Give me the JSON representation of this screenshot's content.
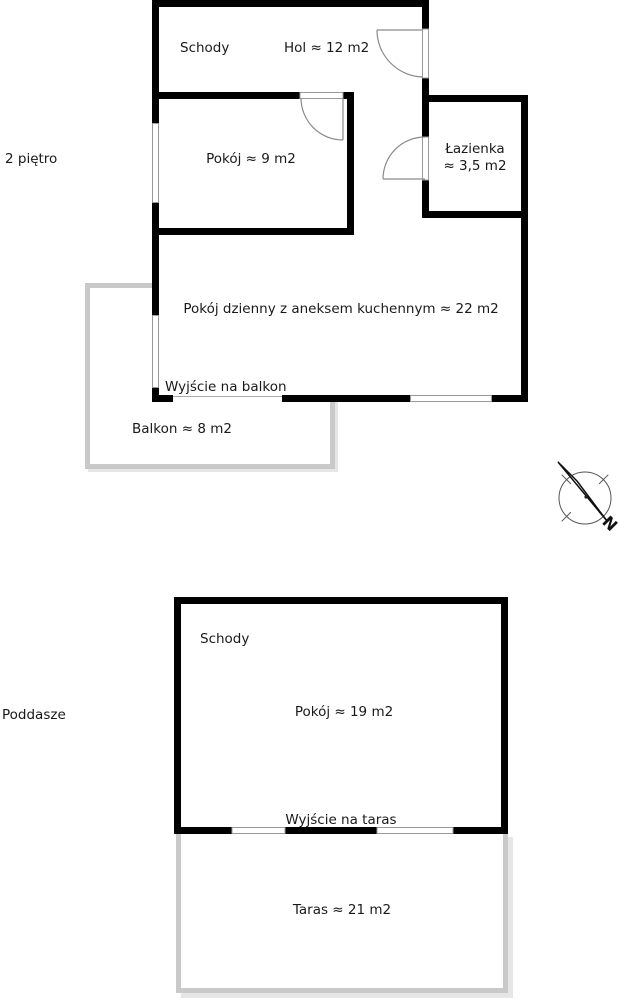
{
  "floor1": {
    "label": "2 piętro",
    "schody": "Schody",
    "hol": "Hol ≈ 12 m2",
    "pokoj": "Pokój ≈ 9 m2",
    "lazienka_line1": "Łazienka",
    "lazienka_line2": "≈ 3,5 m2",
    "living": "Pokój dzienny z aneksem kuchennym ≈ 22 m2",
    "balcony_exit": "Wyjście na balkon",
    "balkon": "Balkon ≈ 8 m2"
  },
  "floor2": {
    "label": "Poddasze",
    "schody": "Schody",
    "pokoj": "Pokój ≈ 19 m2",
    "taras_exit": "Wyjście na taras",
    "taras": "Taras ≈ 21 m2"
  },
  "compass": {
    "north": "N"
  },
  "colors": {
    "wall": "#000000",
    "outdoor_wall": "#c9c9c9",
    "door_line": "#8a8a8a",
    "text": "#1a1a1a",
    "background": "#ffffff"
  }
}
